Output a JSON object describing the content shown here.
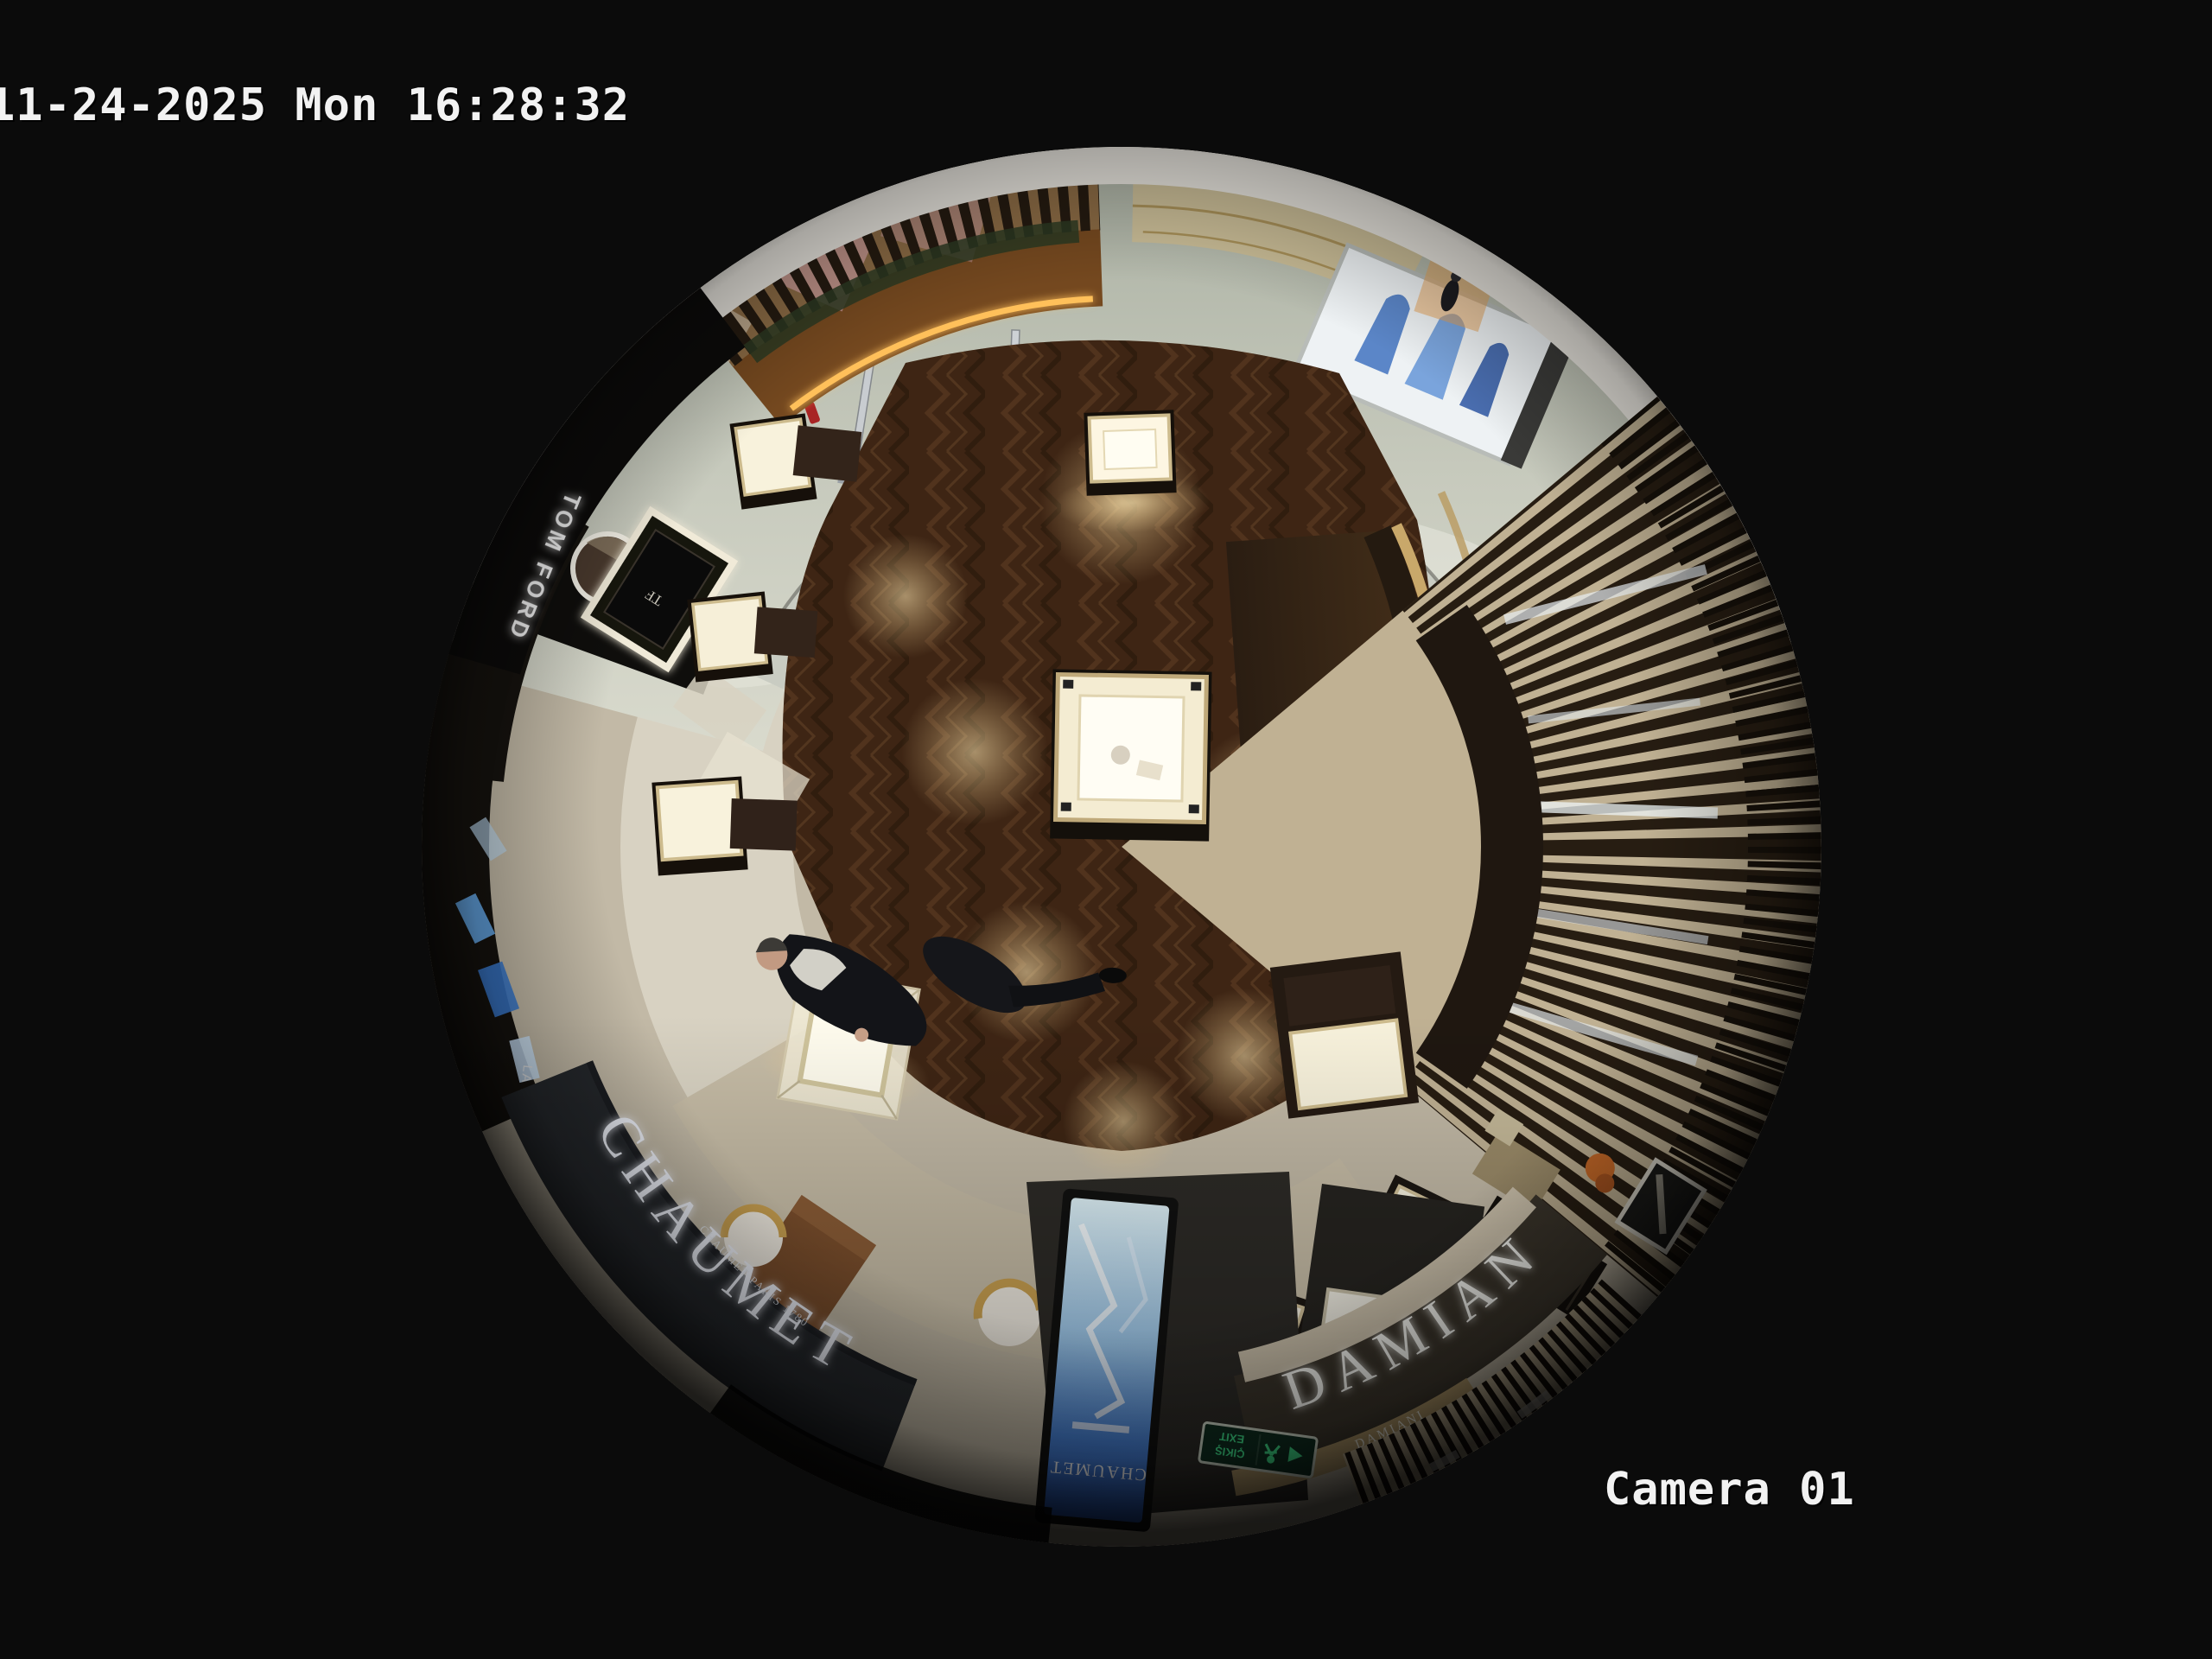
{
  "osd": {
    "timestamp": "11-24-2025 Mon 16:28:32",
    "camera_label": "Camera 01",
    "text_color": "#f2f2f2"
  },
  "scene": {
    "store_signs": {
      "chaumet": "CHAUMET",
      "chaumet_tagline": "CHAUMET PARIS 1780",
      "damiani": "DAMIANI",
      "damiani_small": "DAMIANI",
      "tom_ford": "TOM FORD",
      "tf_monogram": "TF",
      "la_mer": "LA MER",
      "kiosk_screen_brand": "CHAUMET",
      "exit_line1": "ÇIKIŞ",
      "exit_line2": "EXIT"
    },
    "colors": {
      "background": "#0b0b0b",
      "wood_floor": "#452a19",
      "stone_floor": "#cbc3b0",
      "marble_corridor": "#c3c7ba",
      "fascia_dark": "#26292d",
      "led_amber": "#ffc05a",
      "screen_blue": "#2e6fd8",
      "exit_green": "#3fe08a"
    }
  }
}
